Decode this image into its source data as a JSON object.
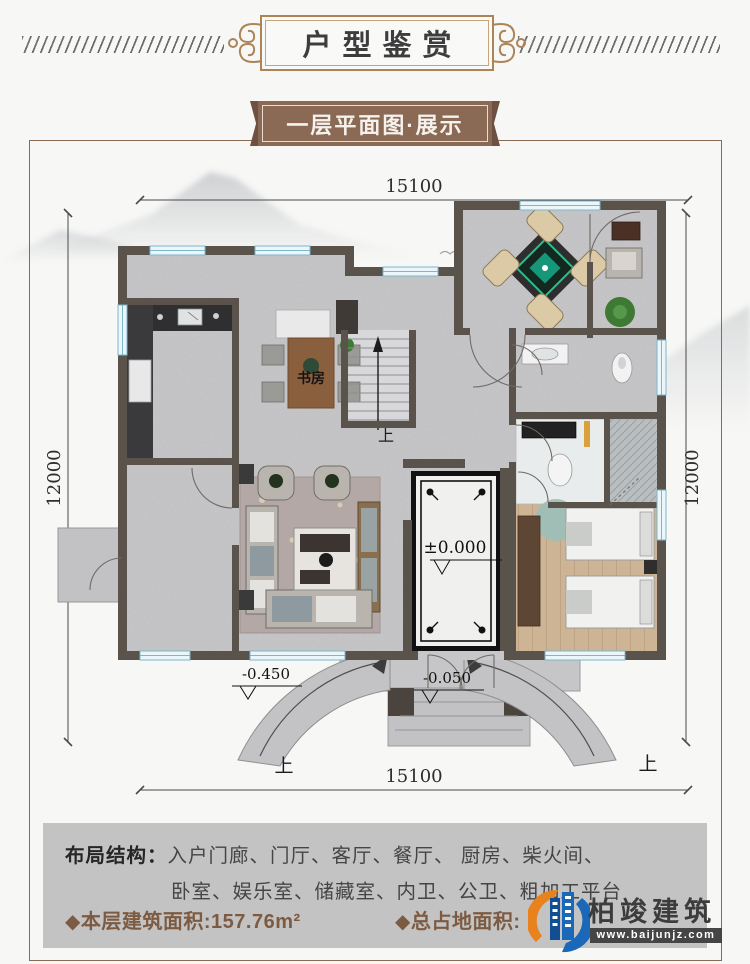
{
  "title": {
    "text": "户型鉴赏"
  },
  "subtitle": {
    "text": "一层平面图·展示"
  },
  "plan": {
    "dims": {
      "top": "15100",
      "bottom": "15100",
      "left": "12000",
      "right": "12000"
    },
    "rooms": {
      "study": "书房"
    },
    "marks": {
      "up_stairs": "上",
      "up_ramp_left": "上",
      "up_ramp_right": "上",
      "level_entry": "±0.000",
      "level_yard": "-0.450",
      "level_porch": "-0.050"
    }
  },
  "info": {
    "layout_label": "布局结构：",
    "layout_line1": "入户门廊、门厅、客厅、餐厅、 厨房、柴火间、",
    "layout_line2": "卧室、娱乐室、储藏室、内卫、公卫、粗加工平台",
    "floor_area": "◆本层建筑面积:157.76m²",
    "total_area": "◆总占地面积:"
  },
  "logo": {
    "name": "柏竣建筑",
    "site": "www.baijunjz.com"
  },
  "colors": {
    "accent": "#8a6a52",
    "wall": "#5a534c",
    "panel": "#c3c3c3",
    "window": "#bfe0ea"
  }
}
